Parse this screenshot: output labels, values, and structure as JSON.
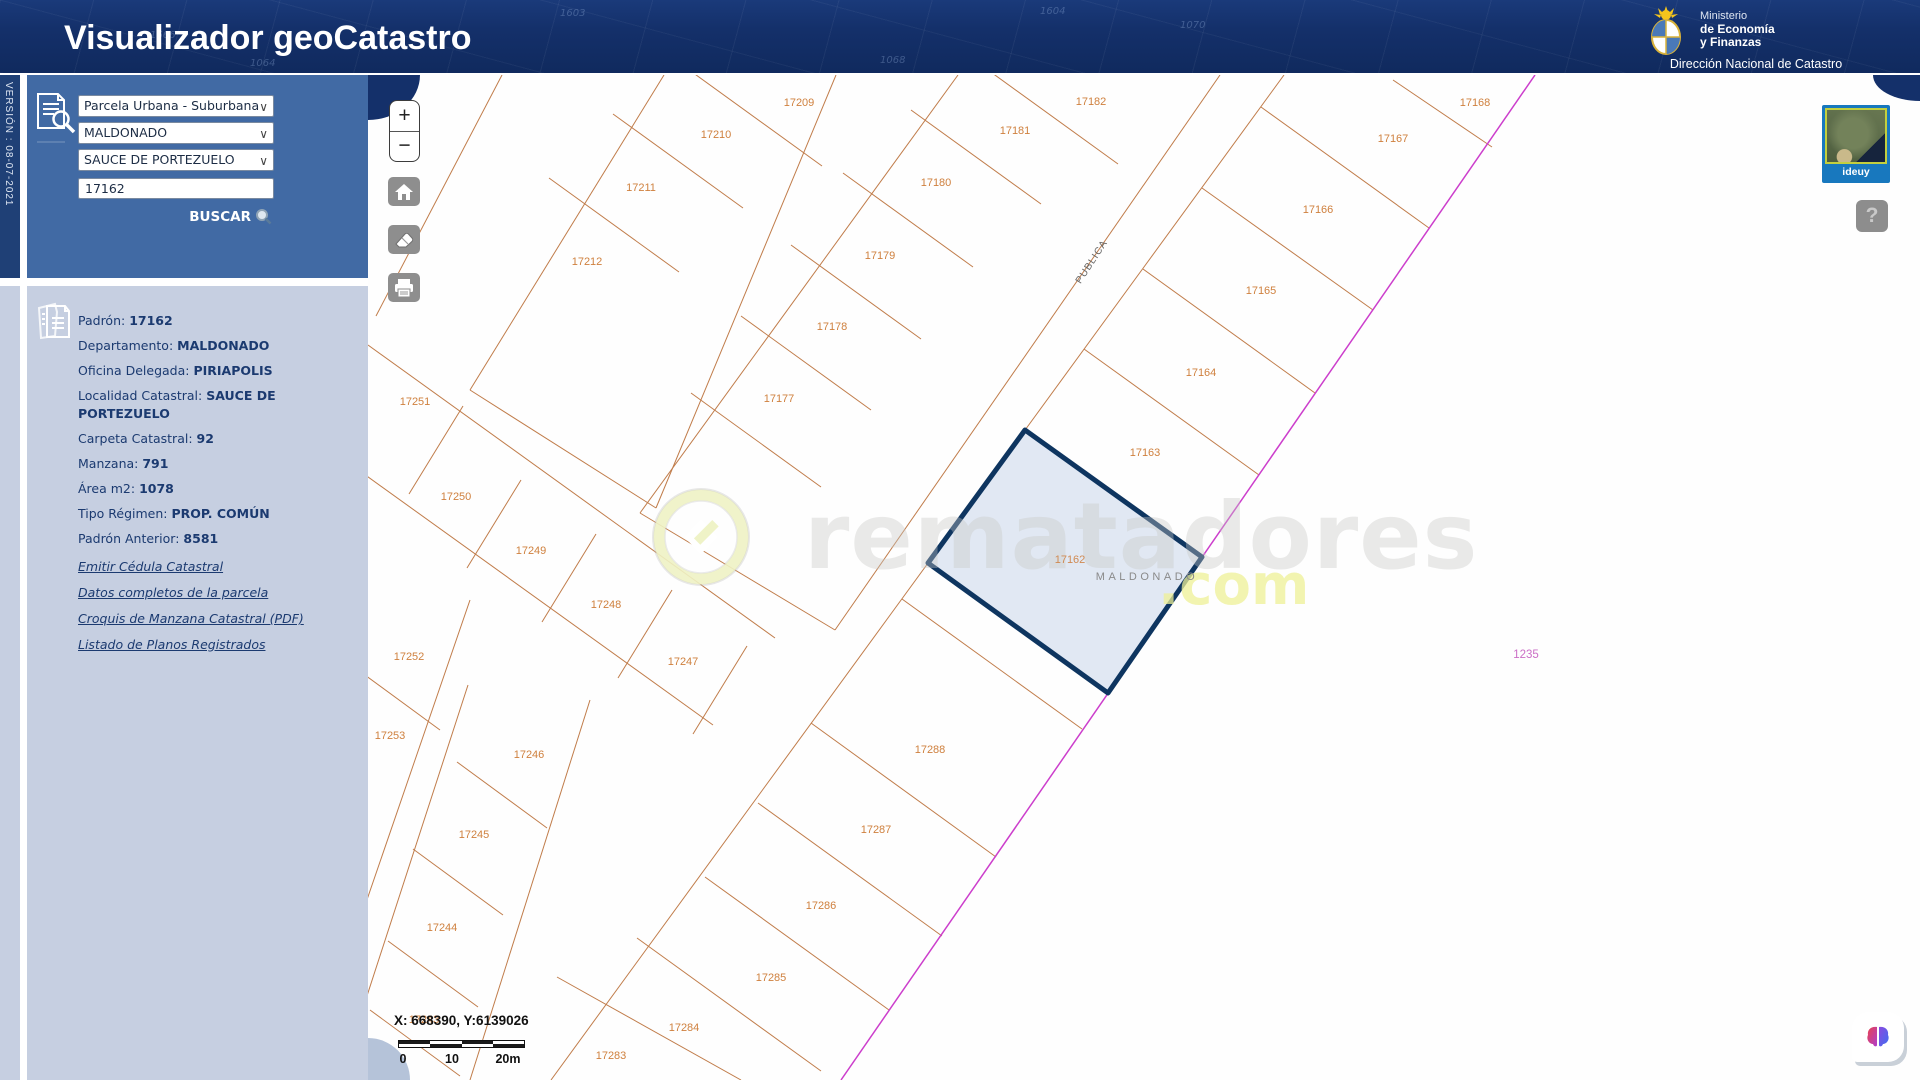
{
  "header": {
    "title": "Visualizador geoCatastro",
    "ministry": {
      "line1": "Ministerio",
      "line2": "de Economía",
      "line3": "y Finanzas",
      "subtitle": "Dirección Nacional de Catastro"
    },
    "bg_numbers": [
      "1603",
      "1604",
      "1064",
      "1666",
      "1068",
      "1070"
    ]
  },
  "version_label": "VERSIÓN : 08-07-2021",
  "search": {
    "selects": [
      "Parcela Urbana - Suburbana",
      "MALDONADO",
      "SAUCE DE PORTEZUELO"
    ],
    "input_value": "17162",
    "buscar_label": "BUSCAR"
  },
  "info": {
    "fields": [
      {
        "label": "Padrón:",
        "value": "17162"
      },
      {
        "label": "Departamento:",
        "value": "MALDONADO"
      },
      {
        "label": "Oficina Delegada:",
        "value": "PIRIAPOLIS"
      },
      {
        "label": "Localidad Catastral:",
        "value": "SAUCE DE PORTEZUELO"
      },
      {
        "label": "Carpeta Catastral:",
        "value": "92"
      },
      {
        "label": "Manzana:",
        "value": "791"
      },
      {
        "label": "Área m2:",
        "value": "1078"
      },
      {
        "label": "Tipo Régimen:",
        "value": "PROP. COMÚN"
      },
      {
        "label": "Padrón Anterior:",
        "value": "8581"
      }
    ],
    "links": [
      "Emitir Cédula Catastral",
      "Datos completos de la parcela",
      "Croquis de Manzana Catastral (PDF)",
      "Listado de Planos Registrados"
    ]
  },
  "map": {
    "controls": {
      "zoom_in": "+",
      "zoom_out": "−"
    },
    "labels": [
      {
        "t": "17213",
        "x": 14,
        "y": 33
      },
      {
        "t": "17209",
        "x": 431,
        "y": 28
      },
      {
        "t": "17210",
        "x": 348,
        "y": 60
      },
      {
        "t": "17211",
        "x": 273,
        "y": 113
      },
      {
        "t": "17212",
        "x": 219,
        "y": 187
      },
      {
        "t": "17182",
        "x": 723,
        "y": 27
      },
      {
        "t": "17181",
        "x": 647,
        "y": 56
      },
      {
        "t": "17180",
        "x": 568,
        "y": 108
      },
      {
        "t": "17179",
        "x": 512,
        "y": 181
      },
      {
        "t": "17178",
        "x": 464,
        "y": 252
      },
      {
        "t": "17177",
        "x": 411,
        "y": 324
      },
      {
        "t": "17168",
        "x": 1107,
        "y": 28
      },
      {
        "t": "17167",
        "x": 1025,
        "y": 64
      },
      {
        "t": "17166",
        "x": 950,
        "y": 135
      },
      {
        "t": "17165",
        "x": 893,
        "y": 216
      },
      {
        "t": "17164",
        "x": 833,
        "y": 298
      },
      {
        "t": "17163",
        "x": 777,
        "y": 378
      },
      {
        "t": "17251",
        "x": 47,
        "y": 327
      },
      {
        "t": "17250",
        "x": 88,
        "y": 422
      },
      {
        "t": "17249",
        "x": 163,
        "y": 476
      },
      {
        "t": "17248",
        "x": 238,
        "y": 530
      },
      {
        "t": "17247",
        "x": 315,
        "y": 587
      },
      {
        "t": "17252",
        "x": 41,
        "y": 582
      },
      {
        "t": "17253",
        "x": 22,
        "y": 661
      },
      {
        "t": "17246",
        "x": 161,
        "y": 680
      },
      {
        "t": "17245",
        "x": 106,
        "y": 760
      },
      {
        "t": "17244",
        "x": 74,
        "y": 853
      },
      {
        "t": "17243",
        "x": 56,
        "y": 945
      },
      {
        "t": "17242",
        "x": -6,
        "y": 991
      },
      {
        "t": "17288",
        "x": 562,
        "y": 675
      },
      {
        "t": "17287",
        "x": 508,
        "y": 755
      },
      {
        "t": "17286",
        "x": 453,
        "y": 831
      },
      {
        "t": "17285",
        "x": 403,
        "y": 903
      },
      {
        "t": "17284",
        "x": 316,
        "y": 953
      },
      {
        "t": "17283",
        "x": 243,
        "y": 981
      }
    ],
    "street_label": {
      "text": "PUBLICA",
      "x": 724,
      "y": 187
    },
    "selected_parcel": {
      "id": "17162",
      "x": 702,
      "y": 485,
      "name_label": {
        "text": "MALDONADO",
        "x": 779,
        "y": 502
      }
    },
    "boundary_label": {
      "text": "1235",
      "x": 1158,
      "y": 580
    },
    "coordinates_text": "X: 668390, Y:6139026",
    "scale": {
      "ticks": [
        "0",
        "10",
        "20m"
      ]
    },
    "colors": {
      "parcel_line": "#c07c4a",
      "parcel_label": "#cf803e",
      "boundary": "#cc3ecc",
      "highlight_fill": "#dce4f1",
      "highlight_stroke": "#0e3560"
    }
  },
  "watermark": {
    "text": "rematadores",
    "com": ".com"
  },
  "widgets": {
    "ideuy_label": "ideuy",
    "help_label": "?"
  }
}
